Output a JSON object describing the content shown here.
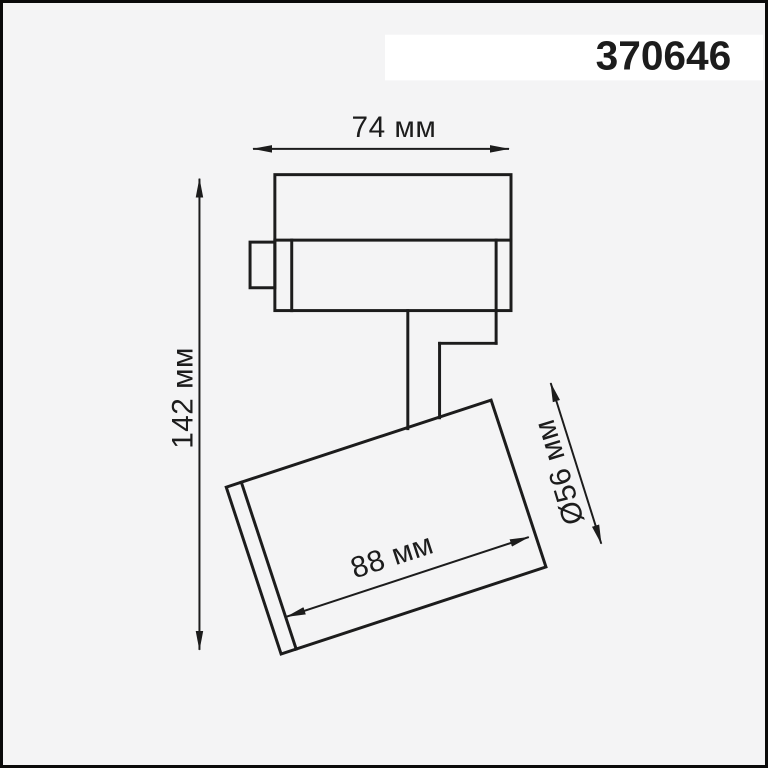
{
  "product_code": "370646",
  "units": "мм",
  "dimensions": {
    "adapter_width": {
      "value": 74,
      "label": "74 мм"
    },
    "overall_height": {
      "value": 142,
      "label": "142 мм"
    },
    "head_length": {
      "value": 88,
      "label": "88 мм"
    },
    "head_diameter": {
      "value": 56,
      "label": "Ø56 мм"
    }
  },
  "colors": {
    "background": "#f4f4f5",
    "frame_border": "#0a0a0a",
    "line": "#1c1c1c",
    "label_box_bg": "#ffffff",
    "text": "#1c1c1c"
  }
}
